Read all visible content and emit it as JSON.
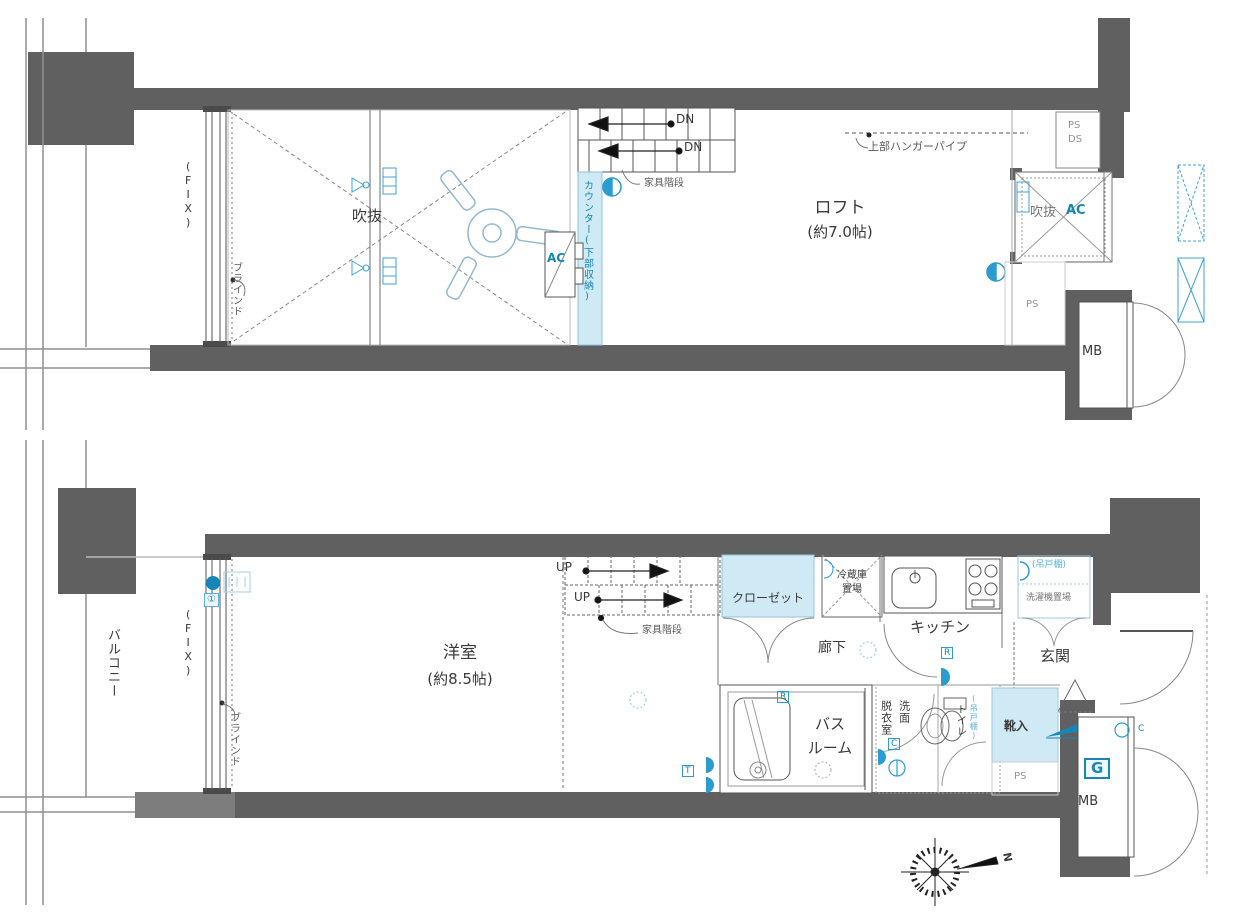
{
  "colors": {
    "wall": "#606060",
    "accent_blue": "#1586b8",
    "light_blue_fill": "#cfe9f5",
    "gray_text": "#949494"
  },
  "loft": {
    "room": "ロフト",
    "size": "(約7.0帖)",
    "void_left": "吹抜",
    "void_right": "吹抜",
    "counter": "カウンター(下部収納)",
    "hanger": "上部ハンガーパイプ",
    "furniture_stairs": "家具階段",
    "dn": "DN",
    "ps": "PS",
    "ds": "DS",
    "ps2": "PS",
    "ac": "AC",
    "mb": "MB",
    "fix": "(FIX)",
    "blind": "ブラインド"
  },
  "main": {
    "balcony": "バルコニー",
    "fix": "(FIX)",
    "blind": "ブラインド",
    "badge": "①",
    "room": "洋室",
    "size": "(約8.5帖)",
    "up": "UP",
    "furniture_stairs": "家具階段",
    "closet": "クローゼット",
    "fridge_line1": "冷蔵庫",
    "fridge_line2": "置場",
    "kitchen": "キッチン",
    "hanging_shelf": "(吊戸棚)",
    "washer": "洗濯機置場",
    "hall": "廊下",
    "entrance": "玄関",
    "bath_line1": "バス",
    "bath_line2": "ルーム",
    "dressing_col1": "脱衣室",
    "dressing_col2": "洗面",
    "toilet": "トイレ",
    "toilet_shelf": "(吊戸棚)",
    "shoe": "靴入",
    "ps": "PS",
    "g": "G",
    "mb": "MB",
    "icon_r": "R",
    "icon_c": "C",
    "icon_t": "T",
    "north": "N"
  }
}
